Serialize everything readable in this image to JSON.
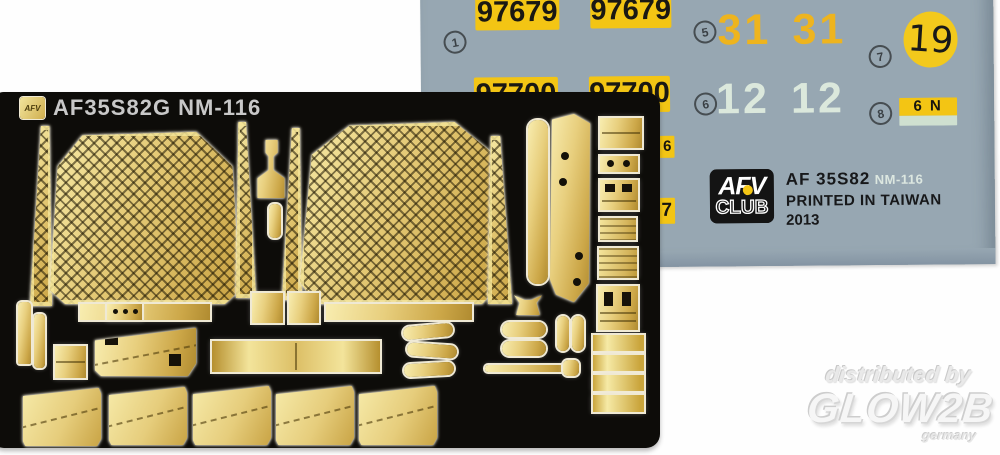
{
  "palette": {
    "sheet_blue": "#97a7b2",
    "decal_yellow": "#f3c514",
    "digit_orange": "#eeb41e",
    "digit_mint": "#dbe8dc",
    "mint_box": "#cfe0d0",
    "brass": "#dcc069",
    "fret_black": "#0d0c09"
  },
  "decal_sheet": {
    "markers": {
      "m1": "1",
      "m5": "5",
      "m6": "6",
      "m7": "7",
      "m8": "8"
    },
    "tag_row1": "97679",
    "tag_row2": "97700",
    "pair_orange": "31",
    "pair_mint": "12",
    "circle_decal": "19",
    "combo_decal": "6 N",
    "edge_fragments": {
      "a": "6",
      "b": "7"
    },
    "maker": {
      "logo_top": "AFV",
      "logo_bottom": "CLUB",
      "product": "AF 35S82",
      "variant": "NM-116",
      "origin": "PRINTED IN TAIWAN",
      "year": "2013"
    }
  },
  "fret": {
    "chip": "AFV",
    "label": "AF35S82G NM-116"
  },
  "watermark": {
    "prefix": "distributed by",
    "brand": "GLOW2B",
    "country": "germany"
  }
}
